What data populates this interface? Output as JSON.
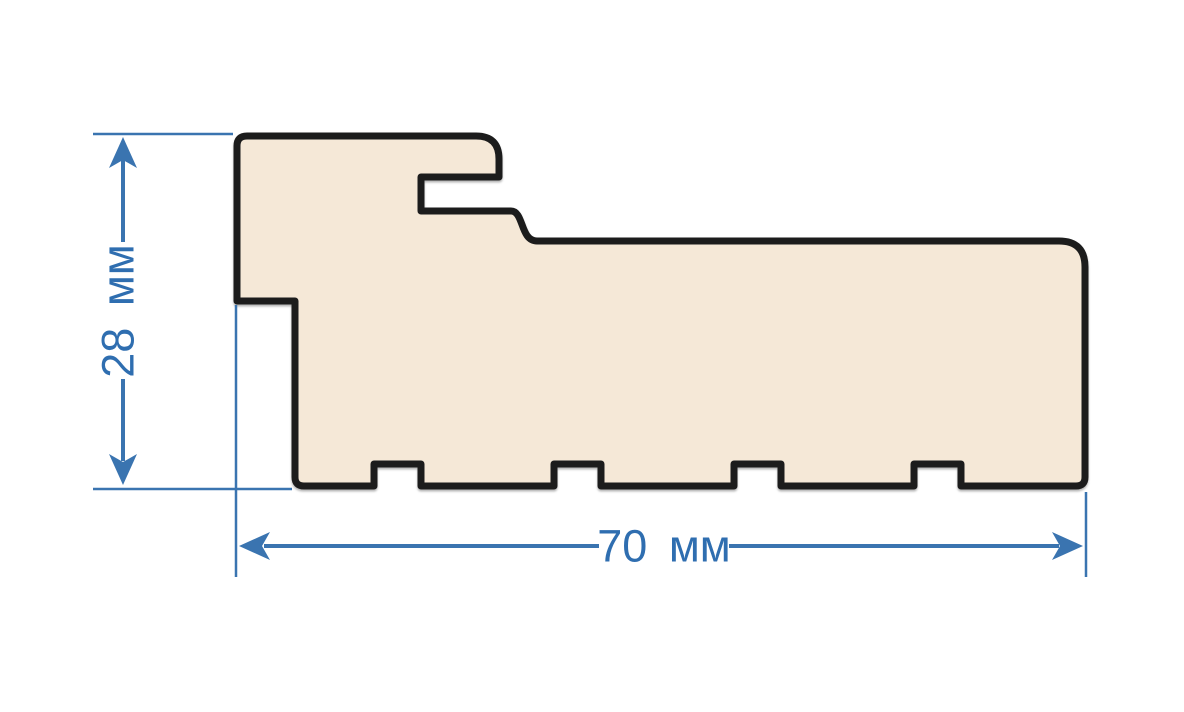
{
  "diagram": {
    "dimensions": {
      "height": {
        "label": "28 мм",
        "value": 28,
        "unit": "мм",
        "orientation": "vertical"
      },
      "width": {
        "label": "70 мм",
        "value": 70,
        "unit": "мм",
        "orientation": "horizontal"
      }
    },
    "colors": {
      "dimension_blue": "#3a74b0",
      "label_blue": "#2f6eb0",
      "profile_fill": "#f5e8d7",
      "profile_outline": "#1c1c1c",
      "background": "#ffffff"
    }
  }
}
